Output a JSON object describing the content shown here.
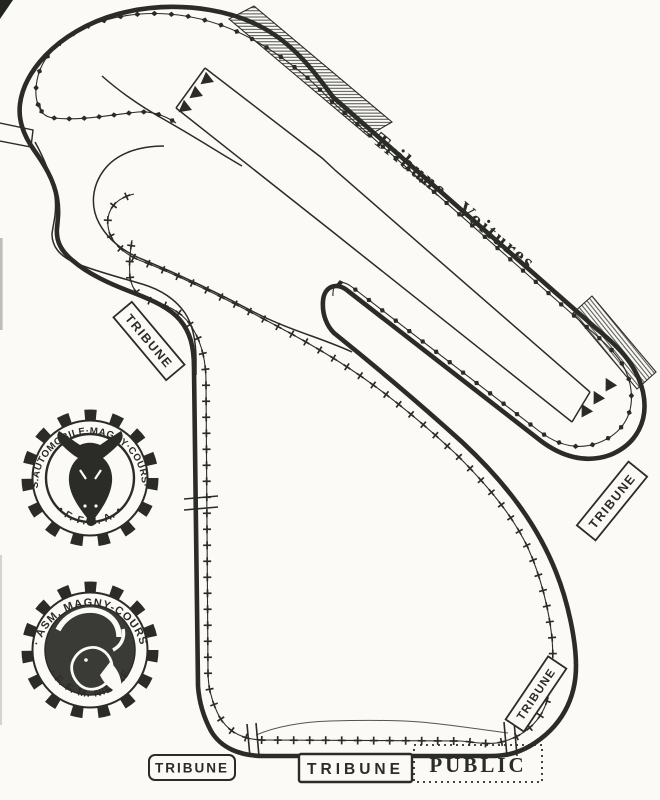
{
  "map": {
    "straight_label": "Tribune  Voitures",
    "stands": {
      "tribune_left": "TRIBUNE",
      "tribune_right": "TRIBUNE",
      "tribune_corner": "TRIBUNE",
      "tribune_bottom_small": "TRIBUNE",
      "tribune_bottom_large": "TRIBUNE",
      "public": "PUBLIC"
    },
    "logos": {
      "auto_club": {
        "ring_top": "A.S.AUTOMOBILE·MAGNY·COURS·58",
        "ring_bottom": "• F. F. S. A. •"
      },
      "moto_club": {
        "ring_top": "· ASM. MAGNY-COURS",
        "ring_bottom": "· F. F. M. NIEVRE"
      }
    },
    "colors": {
      "ink": "#2b2b28",
      "paper": "#fbfaf6"
    }
  }
}
